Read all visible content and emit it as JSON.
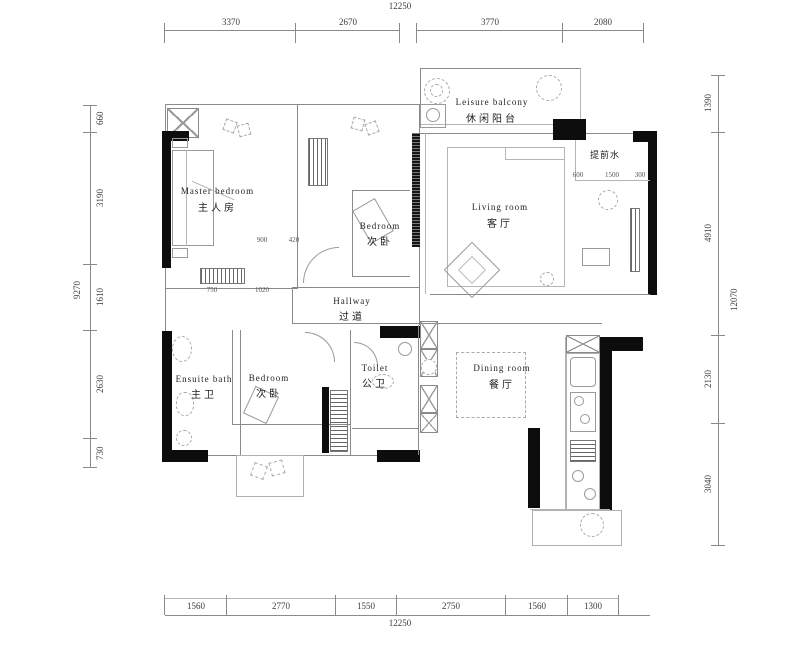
{
  "plan": {
    "rooms": {
      "master_bedroom": {
        "en": "Master bedroom",
        "zh": "主人房"
      },
      "bedroom_upper": {
        "en": "Bedroom",
        "zh": "次卧"
      },
      "living_room": {
        "en": "Living room",
        "zh": "客厅"
      },
      "leisure_balcony": {
        "en": "Leisure balcony",
        "zh": "休闲阳台"
      },
      "hallway": {
        "en": "Hallway",
        "zh": "过道"
      },
      "ensuite_bath": {
        "en": "Ensuite bath",
        "zh": "主卫"
      },
      "bedroom_lower": {
        "en": "Bedroom",
        "zh": "次卧"
      },
      "toilet": {
        "en": "Toilet",
        "zh": "公卫"
      },
      "dining_room": {
        "en": "Dining room",
        "zh": "餐厅"
      },
      "utility": {
        "zh": "提前水"
      }
    },
    "dims": {
      "top": {
        "total": "12250",
        "segments": [
          "3370",
          "2670",
          "3770",
          "2080"
        ]
      },
      "bottom": {
        "total": "12250",
        "segments": [
          "1560",
          "2770",
          "1550",
          "2750",
          "1560",
          "1300"
        ]
      },
      "left": {
        "total": "9270",
        "segments": [
          "660",
          "3190",
          "1610",
          "2630",
          "730"
        ]
      },
      "right": {
        "total": "12070",
        "segments": [
          "1390",
          "4910",
          "2130",
          "3040"
        ]
      },
      "minor": [
        "900",
        "420",
        "750",
        "1020",
        "600",
        "1500",
        "300"
      ]
    },
    "colors": {
      "wall": "#0d0d0d",
      "line": "#8a8a8a",
      "background": "#ffffff"
    }
  }
}
